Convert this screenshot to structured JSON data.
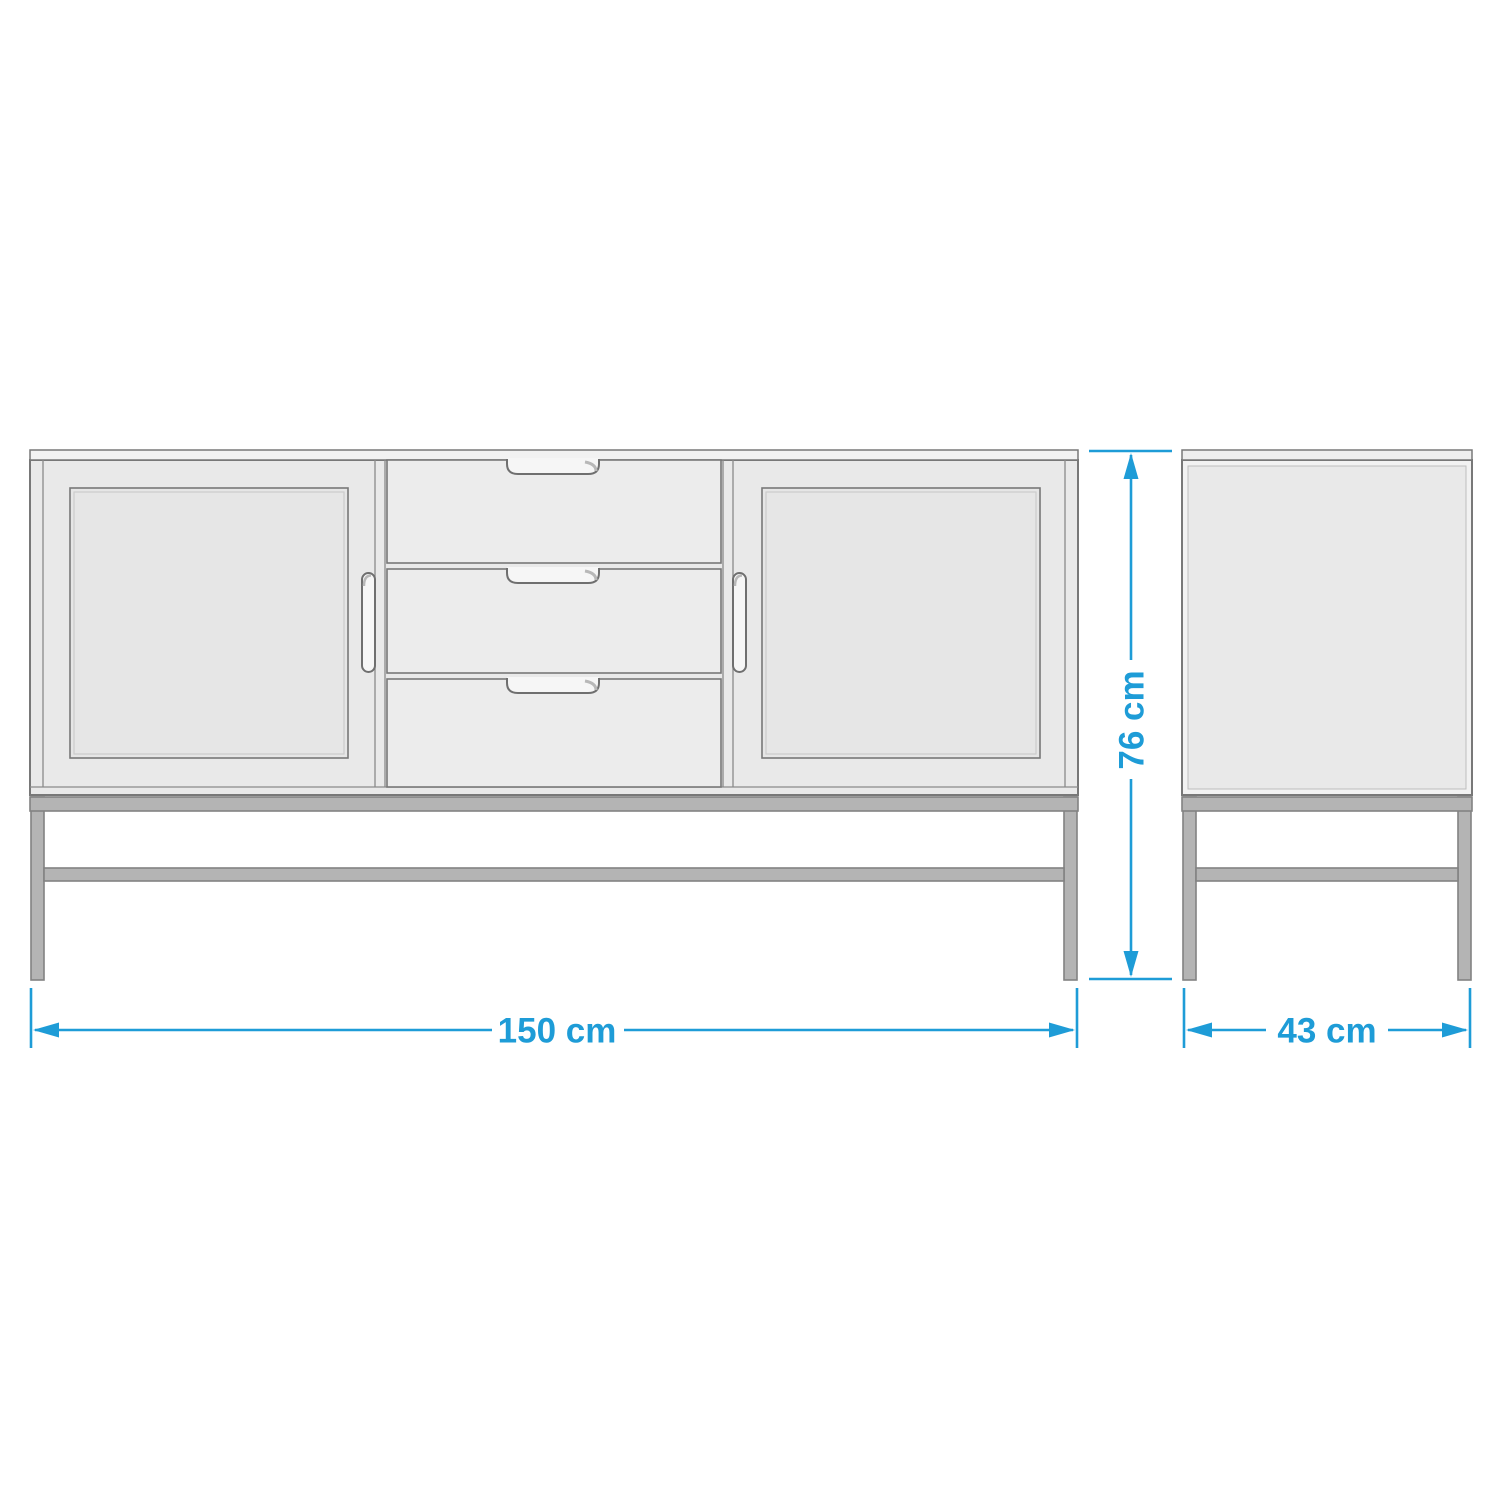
{
  "diagram": {
    "subject": "sideboard-dimension-drawing",
    "views": {
      "front": {
        "doors": 2,
        "drawers": 3,
        "door_handles": 2,
        "drawer_handle_cutouts": 3,
        "base": "metal-frame-4-legs-with-stretcher"
      },
      "side": {
        "panels": 1,
        "base": "metal-frame-4-legs-with-stretcher"
      }
    },
    "dimensions": {
      "width": {
        "label": "150 cm",
        "value": 150,
        "unit": "cm"
      },
      "height": {
        "label": "76 cm",
        "value": 76,
        "unit": "cm"
      },
      "depth": {
        "label": "43 cm",
        "value": 43,
        "unit": "cm"
      }
    },
    "colors": {
      "dimension_accent": "#1e9cd7",
      "outline": "#787878",
      "cabinet_fill": "#e9e9e9",
      "drawer_fill": "#ececec",
      "top_board_fill": "#f2f2f2",
      "base_frame_fill": "#b4b4b4",
      "background": "#ffffff"
    }
  }
}
